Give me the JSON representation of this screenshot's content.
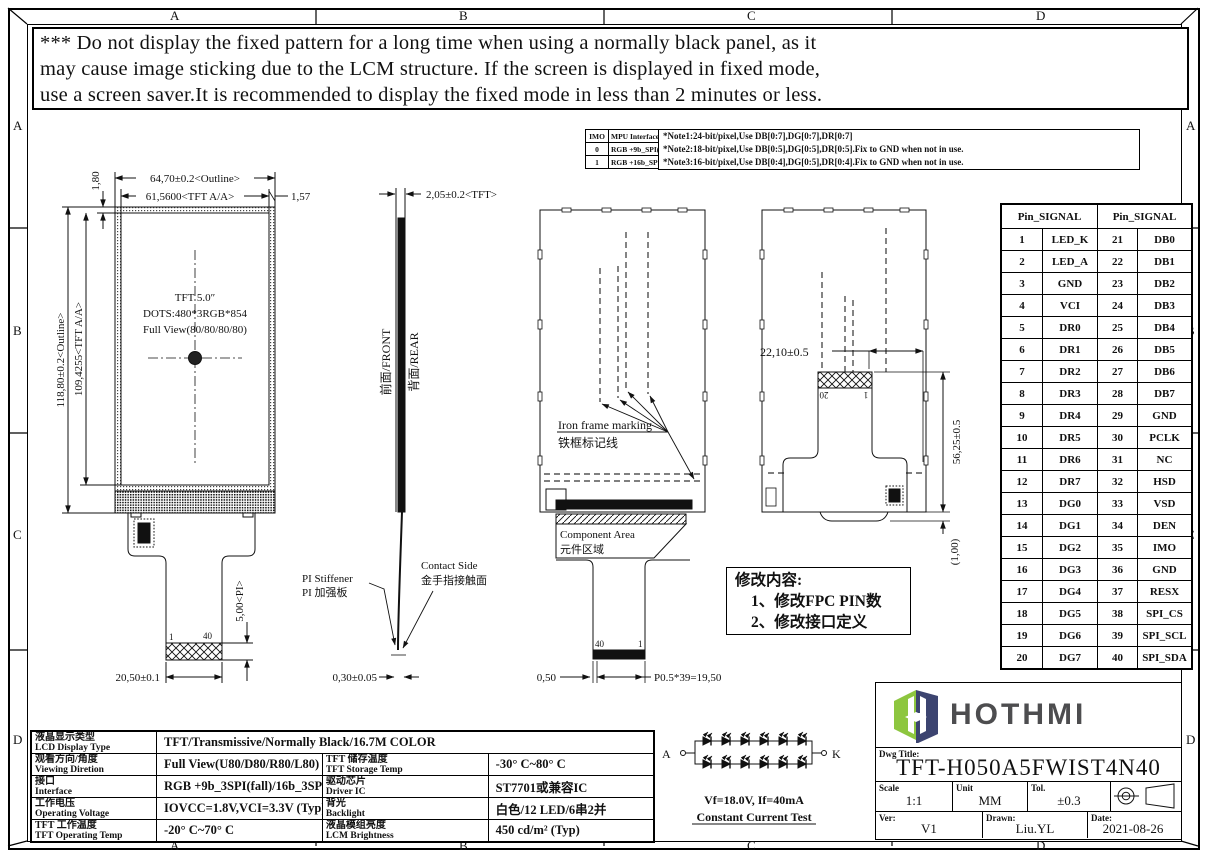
{
  "frame": {
    "cols": [
      "A",
      "B",
      "C",
      "D"
    ],
    "rows": [
      "A",
      "B",
      "C",
      "D"
    ]
  },
  "warning": {
    "line1": "*** Do not display the fixed pattern for a long time when using a normally black panel, as it",
    "line2": " may cause image sticking due to the LCM structure. If the screen is displayed in fixed mode,",
    "line3": " use a screen saver.It is recommended to display the fixed mode in less than 2 minutes or less."
  },
  "imo_table": {
    "h1": "IMO",
    "h2": "MPU Interface Mode",
    "rows": [
      [
        "0",
        "RGB +9b_SPI(fall)"
      ],
      [
        "1",
        "RGB +16b_SPI(rise)"
      ]
    ]
  },
  "notes": {
    "n1": "*Note1:24-bit/pixel,Use DB[0:7],DG[0:7],DR[0:7]",
    "n2": "*Note2:18-bit/pixel,Use DB[0:5],DG[0:5],DR[0:5].Fix to GND  when not in use.",
    "n3": "*Note3:16-bit/pixel,Use DB[0:4],DG[0:5],DR[0:4].Fix to GND  when not in use."
  },
  "pin": {
    "header1": "Pin_SIGNAL",
    "header2": "Pin_SIGNAL",
    "rows": [
      [
        "1",
        "LED_K",
        "21",
        "DB0"
      ],
      [
        "2",
        "LED_A",
        "22",
        "DB1"
      ],
      [
        "3",
        "GND",
        "23",
        "DB2"
      ],
      [
        "4",
        "VCI",
        "24",
        "DB3"
      ],
      [
        "5",
        "DR0",
        "25",
        "DB4"
      ],
      [
        "6",
        "DR1",
        "26",
        "DB5"
      ],
      [
        "7",
        "DR2",
        "27",
        "DB6"
      ],
      [
        "8",
        "DR3",
        "28",
        "DB7"
      ],
      [
        "9",
        "DR4",
        "29",
        "GND"
      ],
      [
        "10",
        "DR5",
        "30",
        "PCLK"
      ],
      [
        "11",
        "DR6",
        "31",
        "NC"
      ],
      [
        "12",
        "DR7",
        "32",
        "HSD"
      ],
      [
        "13",
        "DG0",
        "33",
        "VSD"
      ],
      [
        "14",
        "DG1",
        "34",
        "DEN"
      ],
      [
        "15",
        "DG2",
        "35",
        "IMO"
      ],
      [
        "16",
        "DG3",
        "36",
        "GND"
      ],
      [
        "17",
        "DG4",
        "37",
        "RESX"
      ],
      [
        "18",
        "DG5",
        "38",
        "SPI_CS"
      ],
      [
        "19",
        "DG6",
        "39",
        "SPI_SCL"
      ],
      [
        "20",
        "DG7",
        "40",
        "SPI_SDA"
      ]
    ]
  },
  "front_view": {
    "dim_outline_w": "64,70±0.2<Outline>",
    "dim_aa_w": "61,5600<TFT A/A>",
    "dim_157": "1,57",
    "dim_180": "1,80",
    "dim_outline_h": "118,80±0.2<Outline>",
    "dim_aa_h": "109,4255<TFT A/A>",
    "center1": "TFT 5.0″",
    "center2": "DOTS:480*3RGB*854",
    "center3": "Full View(80/80/80/80)",
    "pin_first": "1",
    "pin_last": "40",
    "dim_pi": "5,00<PI>",
    "dim_tail_w": "20,50±0.1"
  },
  "side_view": {
    "dim_thickness": "2,05±0.2<TFT>",
    "label_front": "前面/FRONT",
    "label_rear": "背面/REAR",
    "stiffener_en": "PI Stiffener",
    "stiffener_cn": "PI 加强板",
    "contact_en": "Contact Side",
    "contact_cn": "金手指接触面",
    "dim_fpc_t": "0,30±0.05"
  },
  "rear_view1": {
    "iron_en": "Iron frame marking",
    "iron_cn": "铁框标记线",
    "comp_en": "Component Area",
    "comp_cn": "元件区域",
    "pin40": "40",
    "pin1": "1",
    "dim_050": "0,50",
    "dim_pitch": "P0.5*39=19,50"
  },
  "rear_view2": {
    "dim_2210": "22,10±0.5",
    "pin20": "20",
    "pin1": "1",
    "dim_5625": "56,25±0.5",
    "dim_100": "(1,00)"
  },
  "revision": {
    "title": "修改内容:",
    "item1": "1、修改FPC PIN数",
    "item2": "2、修改接口定义"
  },
  "led": {
    "anode": "A",
    "cathode": "K",
    "spec": "Vf=18.0V, If=40mA",
    "test": "Constant Current Test"
  },
  "spec_table": {
    "rows": [
      {
        "cn": "液晶显示类型",
        "en": "LCD Display Type",
        "value": "TFT/Transmissive/Normally Black/16.7M COLOR"
      },
      {
        "cn": "观看方向/角度",
        "en": "Viewing Diretion",
        "value": "Full View(U80/D80/R80/L80)",
        "cn2": "TFT 储存温度",
        "en2": "TFT Storage Temp",
        "value2": "-30° C~80° C"
      },
      {
        "cn": "接口",
        "en": "Interface",
        "value": "RGB +9b_3SPI(fall)/16b_3SPI(rise)",
        "cn2": "驱动芯片",
        "en2": "Driver IC",
        "value2": "ST7701或兼容IC"
      },
      {
        "cn": "工作电压",
        "en": "Operating Voltage",
        "value": "IOVCC=1.8V,VCI=3.3V (Typ)",
        "cn2": "背光",
        "en2": "Backlight",
        "value2": "白色/12 LED/6串2并"
      },
      {
        "cn": "TFT 工作温度",
        "en": "TFT Operating Temp",
        "value": "-20° C~70° C",
        "cn2": "液晶模组亮度",
        "en2": "LCM Brightness",
        "value2": "450 cd/m² (Typ)"
      }
    ]
  },
  "title_block": {
    "logo_text": "HOTHMI",
    "dwg_label": "Dwg Title:",
    "dwg_title": "TFT-H050A5FWIST4N40",
    "scale_label": "Scale",
    "scale": "1:1",
    "unit_label": "Unit",
    "unit": "MM",
    "tol_label": "Tol.",
    "tol": "±0.3",
    "ver_label": "Ver:",
    "ver": "V1",
    "drawn_label": "Drawn:",
    "drawn": "Liu.YL",
    "date_label": "Date:",
    "date": "2021-08-26"
  },
  "colors": {
    "logo_green": "#8dc63f",
    "logo_navy": "#313a68",
    "logo_gray": "#4d4d4f"
  }
}
